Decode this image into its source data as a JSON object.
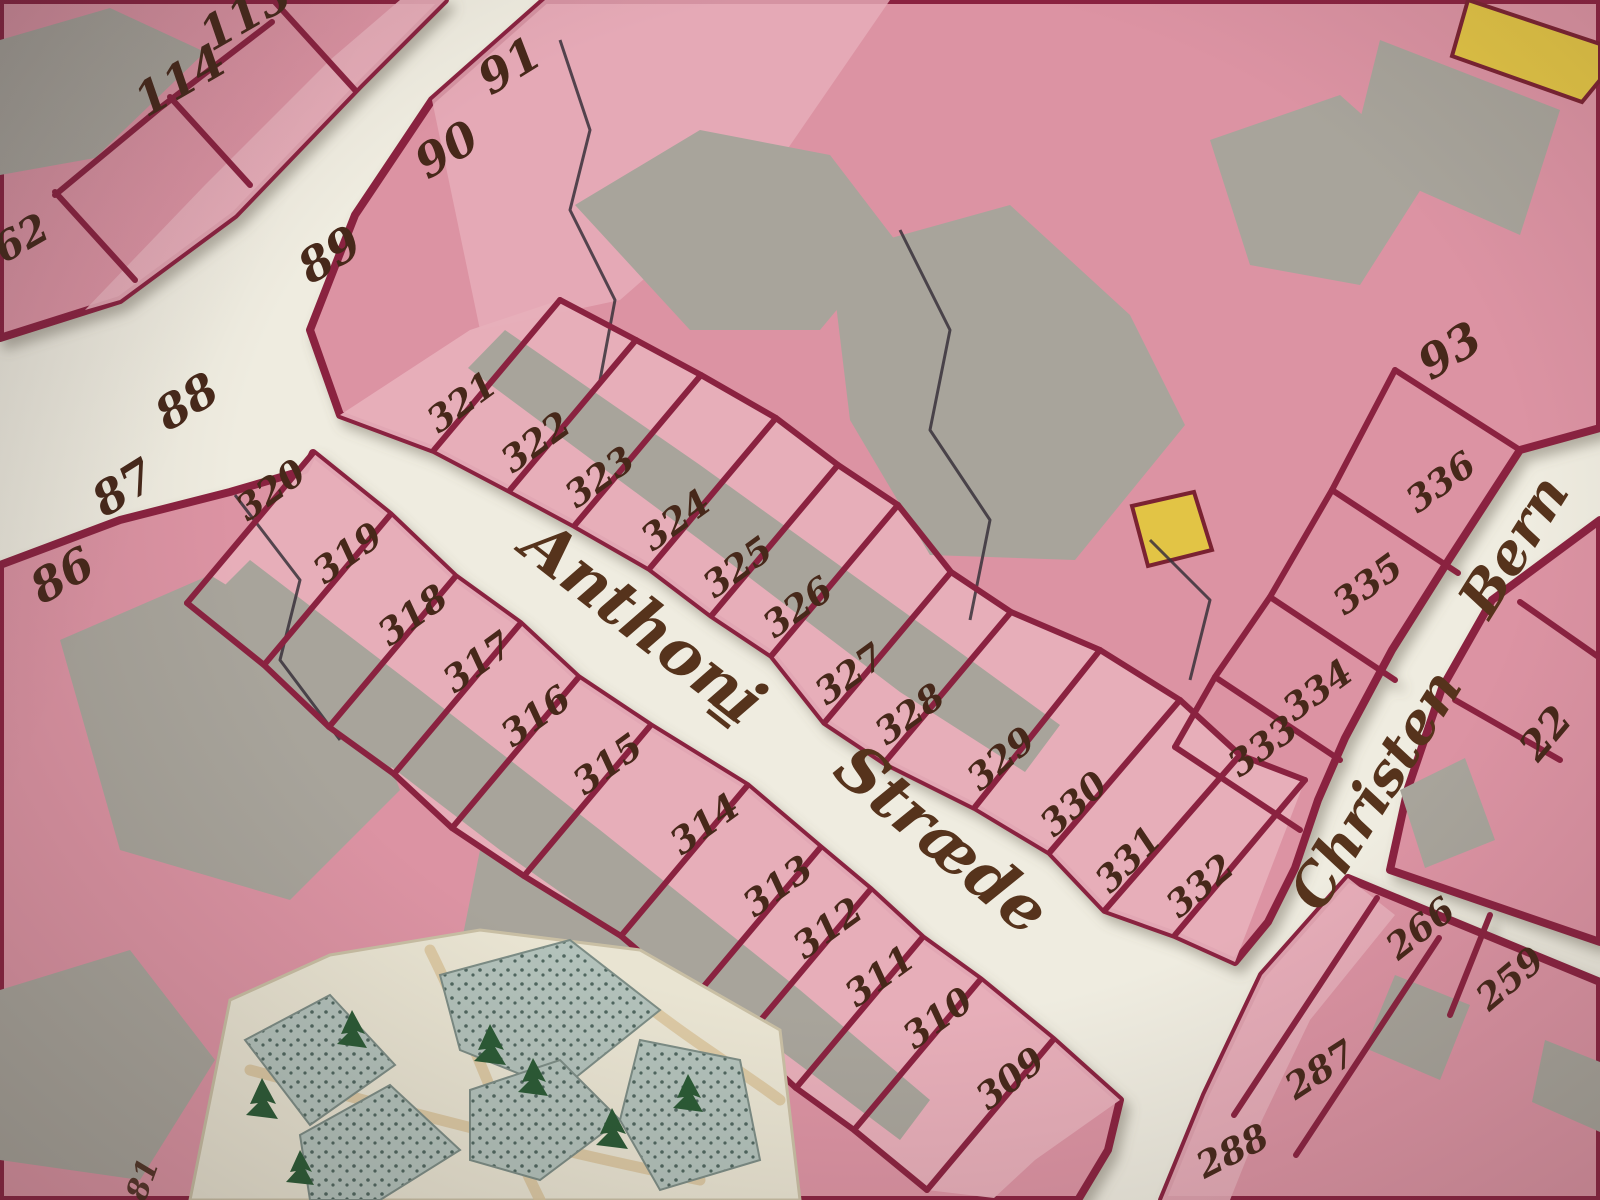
{
  "labels": {
    "62": "62",
    "81": "81",
    "86": "86",
    "87": "87",
    "88": "88",
    "89": "89",
    "90": "90",
    "91": "91",
    "93": "93",
    "113": "113",
    "114": "114",
    "22": "22",
    "259": "259",
    "266": "266",
    "287": "287",
    "288": "288",
    "309": "309",
    "310": "310",
    "311": "311",
    "312": "312",
    "313": "313",
    "314": "314",
    "315": "315",
    "316": "316",
    "317": "317",
    "318": "318",
    "319": "319",
    "320": "320",
    "321": "321",
    "322": "322",
    "323": "323",
    "324": "324",
    "325": "325",
    "326": "326",
    "327": "327",
    "328": "328",
    "329": "329",
    "330": "330",
    "331": "331",
    "332": "332",
    "333": "333",
    "334": "334",
    "335": "335",
    "336": "336"
  },
  "streets": {
    "anthoni": {
      "word1": "Anthoni",
      "separator": "=",
      "word2": "Stræde"
    },
    "christen": {
      "word1": "Christen",
      "word2": "Bern"
    }
  },
  "palette": {
    "paper": "#efece0",
    "building_pink": "#dc93a3",
    "building_pink_light": "#e7afba",
    "outline_red": "#8a2440",
    "courtyard_gray": "#a8a49b",
    "divider_dark": "#38313b",
    "yellow_building": "#e2c445",
    "garden_bed": "#b3c2bb",
    "garden_dot": "#4f665e",
    "garden_path": "#d9c49c",
    "tree_green": "#2c5a34",
    "ink_brown": "#47281a"
  },
  "icons": {
    "tree": "conifer-tree-icon"
  }
}
